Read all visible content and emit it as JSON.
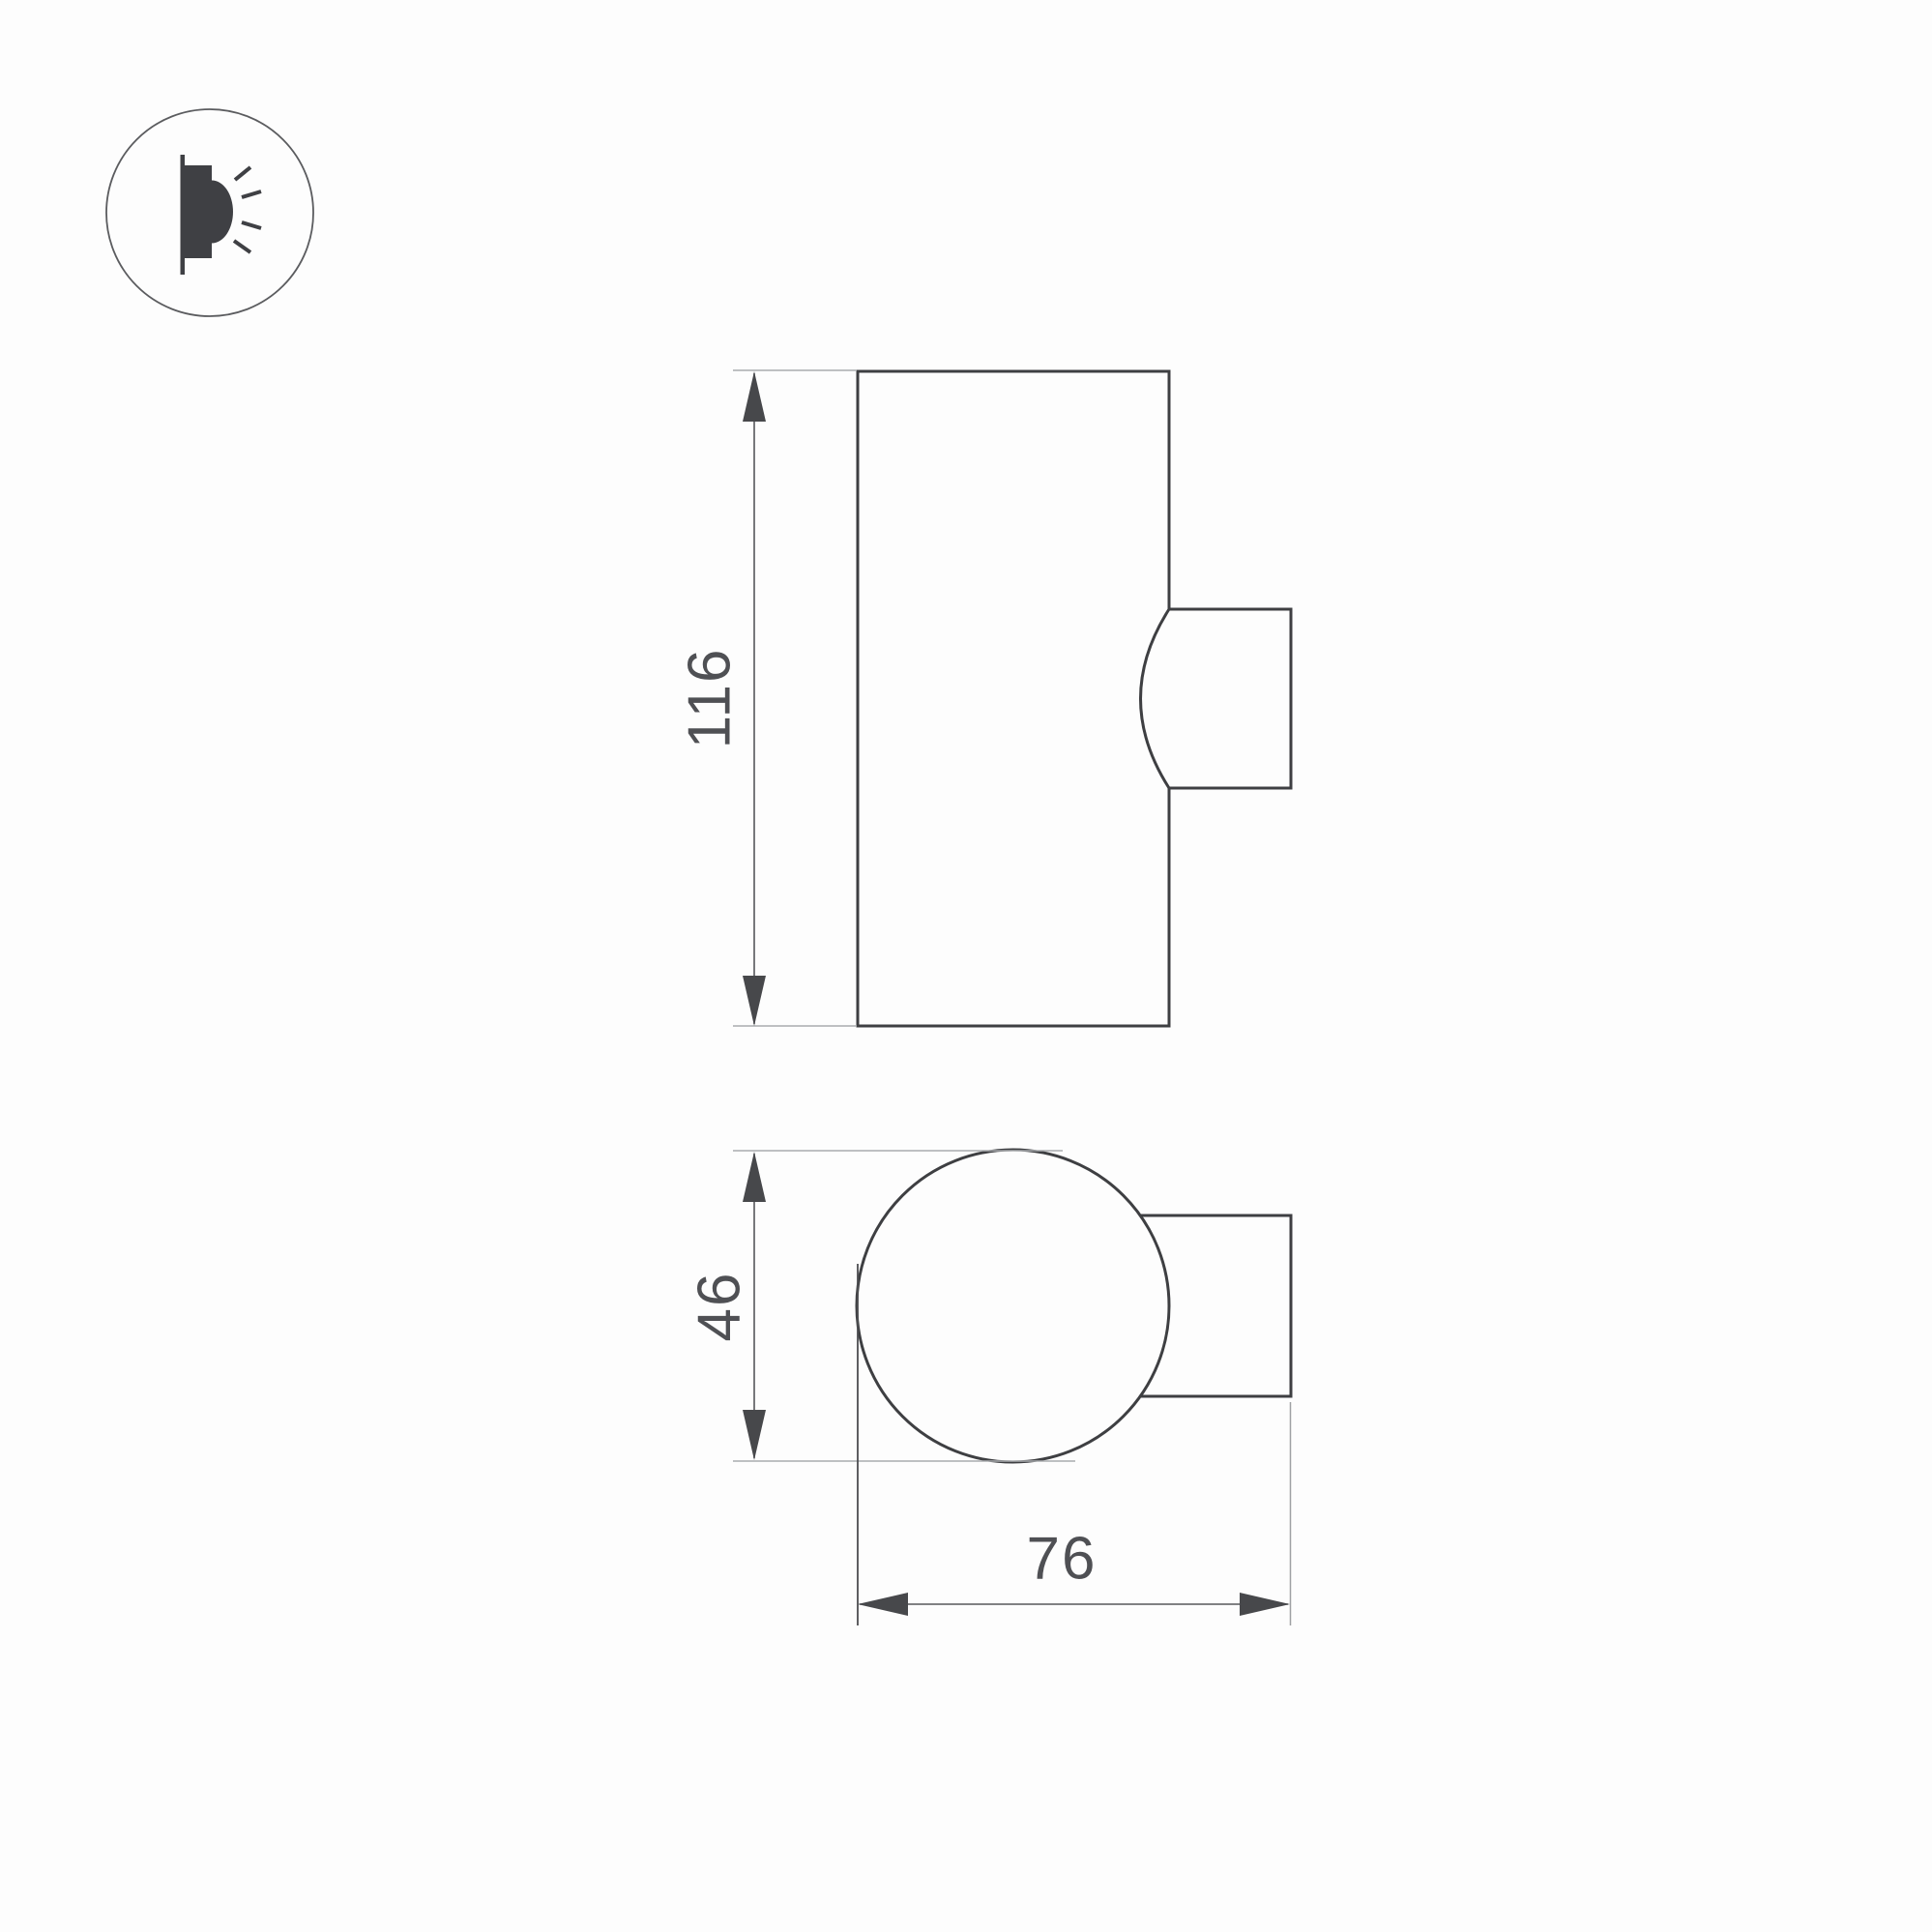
{
  "page": {
    "background": "#fdfdfd",
    "type": "technical-dimension-drawing"
  },
  "icon": {
    "name": "wall-mounted-light-emitting-icon"
  },
  "dimensions": {
    "height": {
      "value": "116"
    },
    "diameter": {
      "value": "46"
    },
    "depth": {
      "value": "76"
    }
  },
  "colors": {
    "outline": "#3e3f42",
    "dimension_line": "#57585b",
    "extension_line": "#a9abae",
    "arrow": "#47484b",
    "text": "#4f5054",
    "icon_fill": "#3f4044",
    "background": "#fdfdfd"
  }
}
